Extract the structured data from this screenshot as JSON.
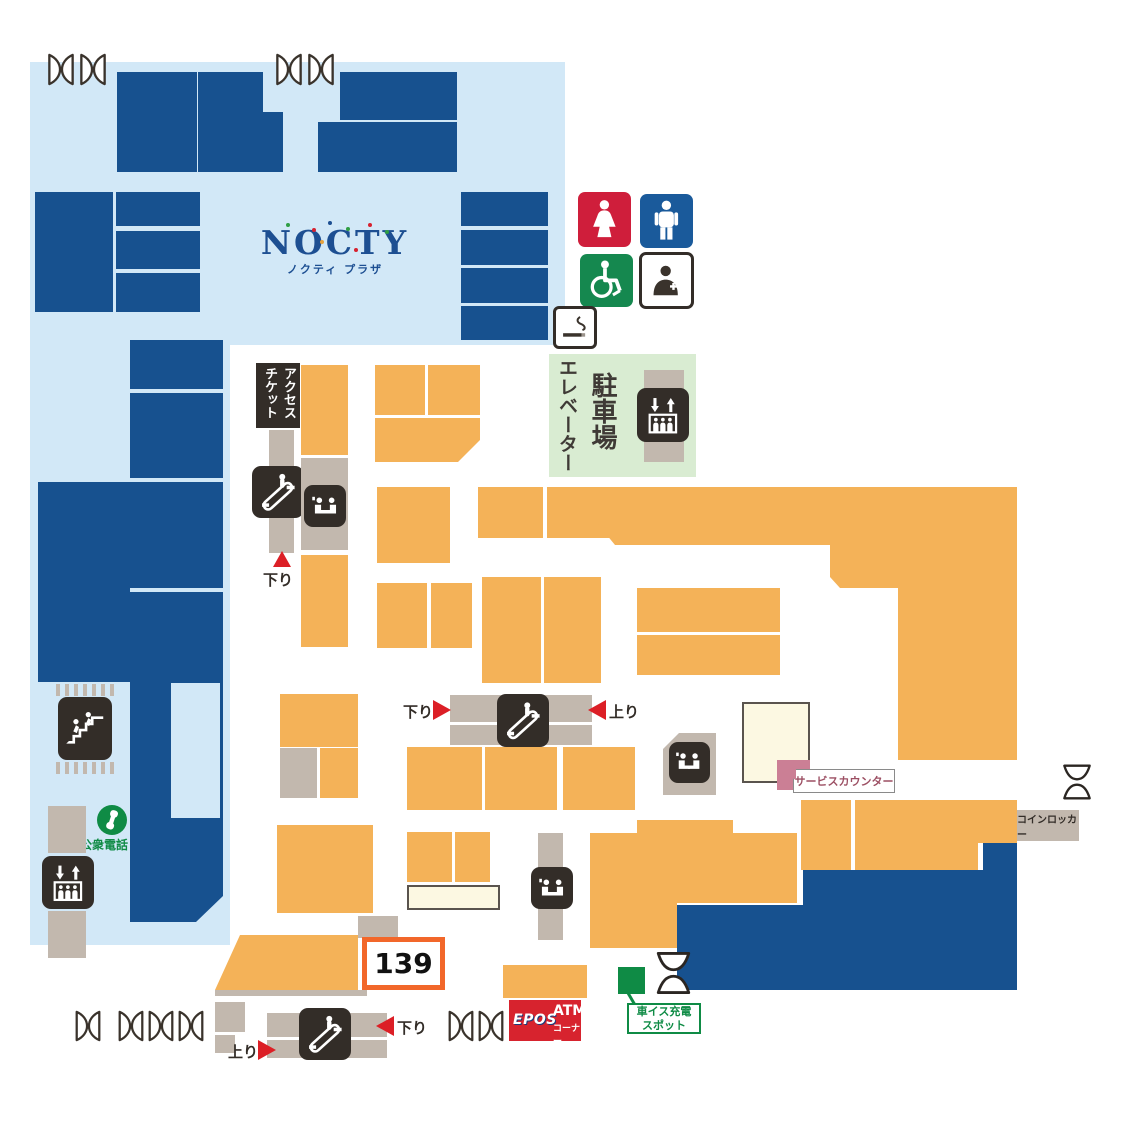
{
  "logo": {
    "title": "NOCTY",
    "subtitle": "ノクティ プラザ"
  },
  "labels": {
    "access_ticket": "アクセスチケット",
    "parking": "駐車場",
    "elevator": "エレベーター",
    "down": "下り",
    "up": "上り",
    "service_counter": "サービスカウンター",
    "coin_locker": "コインロッカー",
    "public_phone": "公衆電話",
    "wheelchair_charge_line1": "車イス充電",
    "wheelchair_charge_line2": "スポット",
    "store_number": "139",
    "atm_brand": "EPOS",
    "atm": "ATM",
    "atm_sub": "コーナー"
  },
  "colors": {
    "navy": "#17518f",
    "orange": "#f4b258",
    "light_blue": "#d2e8f7",
    "gray": "#c2b8ae",
    "dark": "#332d28",
    "green_area": "#d9ecd2",
    "green": "#0f8b45",
    "red": "#dc1f26",
    "women_red": "#cf1e3b",
    "men_blue": "#1a5a9b",
    "wheelchair_green": "#15884f",
    "pink": "#cb7f95",
    "cream": "#fcf8e2",
    "epos_red": "#d7232e",
    "highlight": "#f2672a",
    "logo_navy": "#1d4f92",
    "counter_text": "#9c4f63"
  }
}
